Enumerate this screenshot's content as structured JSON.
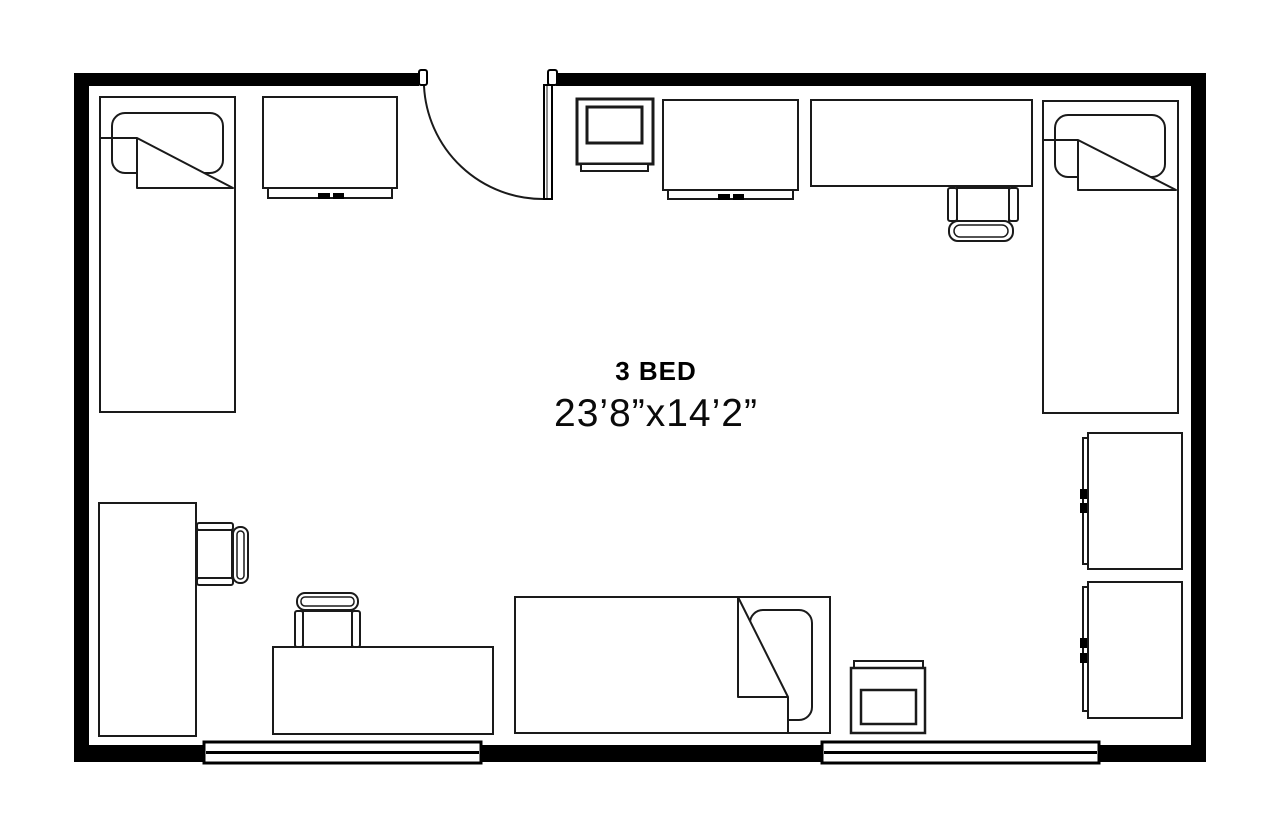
{
  "floorplan": {
    "room_label": "3 BED",
    "room_size": "23’8”x14’2”",
    "colors": {
      "wall": "#000000",
      "line": "#1a1a1a",
      "background": "#ffffff"
    },
    "furniture_icons": [
      "bed-icon",
      "bed-icon",
      "bed-icon",
      "dresser-icon",
      "dresser-icon",
      "tv-icon",
      "desk-icon",
      "desk-icon",
      "desk-chair-icon",
      "desk-chair-icon",
      "desk-chair-icon",
      "wardrobe-icon",
      "wardrobe-icon",
      "nightstand-icon",
      "door-swing-icon",
      "window-icon",
      "window-icon"
    ]
  }
}
